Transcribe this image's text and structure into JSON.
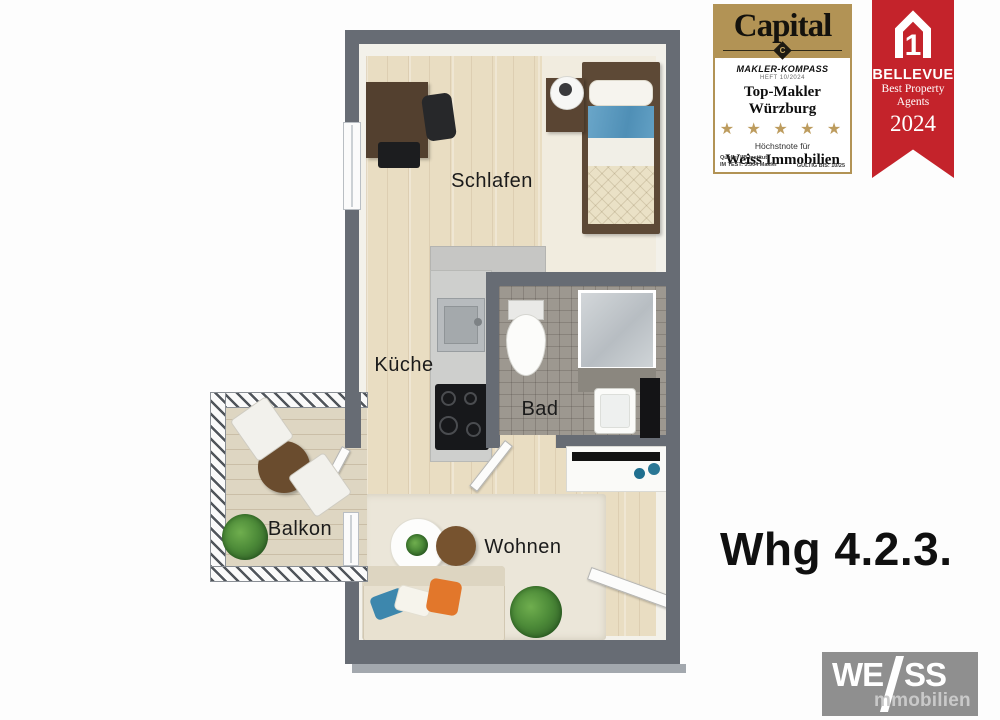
{
  "floorplan": {
    "apartment_label": "Whg 4.2.3.",
    "rooms": [
      {
        "id": "schlafen",
        "label": "Schlafen"
      },
      {
        "id": "kueche",
        "label": "Küche"
      },
      {
        "id": "bad",
        "label": "Bad"
      },
      {
        "id": "wohnen",
        "label": "Wohnen"
      },
      {
        "id": "balkon",
        "label": "Balkon"
      }
    ]
  },
  "badges": {
    "capital": {
      "brand": "Capital",
      "emblem_letter": "C",
      "program": "MAKLER-KOMPASS",
      "issue": "HEFT 10/2024",
      "award_title": "Top-Makler Würzburg",
      "stars": 5,
      "stars_text": "★ ★ ★ ★ ★",
      "subtitle": "Höchstnote für",
      "recipient": "Weiss Immobilien",
      "source_line1": "Quelle: IIB Institut",
      "source_line2": "IM TEST: 3.504 Makler",
      "valid_text": "GÜLTIG BIS: 10/25",
      "gold_color": "#b29355"
    },
    "bellevue": {
      "brand": "BELLEVUE",
      "award_line1": "Best Property",
      "award_line2": "Agents",
      "year": "2024",
      "house_number": "1",
      "red_color": "#c4232b"
    }
  },
  "logo": {
    "part1": "WE",
    "part2": "SS",
    "part3": "mmobilien"
  },
  "colors": {
    "wall": "#676c74",
    "wood_floor": "#e9ddc2",
    "bath_tiles": "#9d9890",
    "rug": "#ebe6d9",
    "capital_gold": "#b29355",
    "bellevue_red": "#c4232b",
    "logo_gray": "#8f8f8f"
  }
}
